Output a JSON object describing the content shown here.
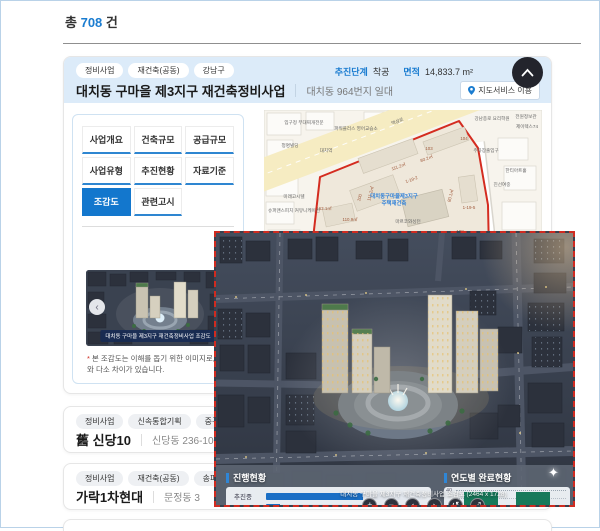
{
  "page": {
    "total_prefix": "총",
    "total_count": "708",
    "total_suffix": "건"
  },
  "project_card": {
    "tags": [
      "정비사업",
      "재건축(공동)",
      "강남구"
    ],
    "title": "대치동 구마을 제3지구 재건축정비사업",
    "address": "대치동 964번지 일대",
    "stage_label": "추진단계",
    "stage_value": "착공",
    "area_label": "면적",
    "area_value": "14,833.7 m²",
    "map_service_button": "지도서비스 이용",
    "tabs": [
      "사업개요",
      "건축규모",
      "공급규모",
      "사업유형",
      "추진현황",
      "자료기준",
      "조감도",
      "관련고시"
    ],
    "active_tab": "조감도",
    "thumbnail_caption": "대치동 구마을 제3지구 재건축정비사업 조감도",
    "disclaimer_mark": "*",
    "disclaimer": "본 조감도는 이해를 돕기 위한 이미지로, 실제와 다소 차이가 있습니다."
  },
  "map": {
    "road_label": "역삼로",
    "zone_label_line1": "대치동구마을제3지구",
    "zone_label_line2": "주택재건축",
    "labels": [
      "입구정 부대찌개전문",
      "파워플러스 영어교습소",
      "청명빌딩",
      "대치역",
      "미래고시텔",
      "슈퍼맨스피치 커뮤니케이션",
      "강남종로 요리학원",
      "전원정보관",
      "제이렉스74",
      "주차장출입구",
      "한티아트홀",
      "진선여중",
      "마르코와싱턴"
    ],
    "lots": [
      "103",
      "104",
      "111.2㎡",
      "80.2㎡",
      "1-19-2",
      "163.1㎡",
      "110.9㎡",
      "100",
      "111.2㎡",
      "80.1㎡",
      "1-19-5",
      "108"
    ]
  },
  "overlay": {
    "caption": "대치동 구마을 제3지구 재건축정비사업 조감도 (2464 x 1728)",
    "progress": {
      "title": "진행현황",
      "rows": [
        {
          "label": "추진중",
          "value": 62
        },
        {
          "label": "",
          "value": 9
        }
      ]
    },
    "yearly": {
      "title": "연도별 완료현황",
      "tick": "40",
      "bars": [
        {
          "value": 75
        },
        {
          "value": 75
        }
      ]
    },
    "controls": [
      {
        "name": "zoom-in",
        "glyph": "+"
      },
      {
        "name": "zoom-out",
        "glyph": "−"
      },
      {
        "name": "prev",
        "glyph": "‹"
      },
      {
        "name": "next",
        "glyph": "›"
      },
      {
        "name": "reset",
        "glyph": "↺"
      },
      {
        "name": "fullscreen",
        "glyph": "⤢"
      }
    ]
  },
  "list_cards": [
    {
      "tags": [
        "정비사업",
        "신속통합기획",
        "중구"
      ],
      "title": "舊 신당10",
      "address": "신당동 236-100 일대"
    },
    {
      "tags": [
        "정비사업",
        "재건축(공동)",
        "송파구"
      ],
      "title": "가락1차현대",
      "address": "문정동 3"
    }
  ],
  "colors": {
    "accent_blue": "#1a7cd0",
    "active_tab": "#1377cd",
    "boundary_red": "#d42c20",
    "progress_bar": "#1b6fc5",
    "yearly_bar": "#17795a",
    "header_bg": "#dcebf9"
  }
}
